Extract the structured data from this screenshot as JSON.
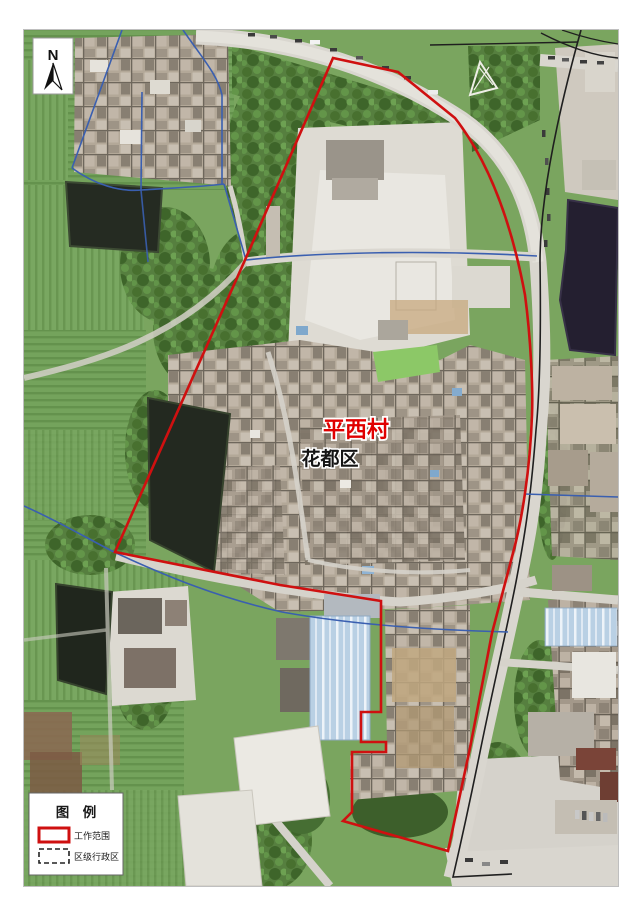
{
  "map": {
    "north_label": "N",
    "labels": {
      "village": {
        "text": "平西村",
        "color": "#e00000"
      },
      "district": {
        "text": "花都区",
        "color": "#141414"
      }
    }
  },
  "legend": {
    "title": "图　例",
    "items": [
      {
        "label": "工作范围",
        "swatch": "work-scope-red-rect"
      },
      {
        "label": "区级行政区",
        "swatch": "district-dashed-rect"
      }
    ]
  },
  "colors": {
    "work_boundary": "#cf1010",
    "admin_boundary": "#3a5fb0",
    "road_line": "#1f1f1f"
  }
}
